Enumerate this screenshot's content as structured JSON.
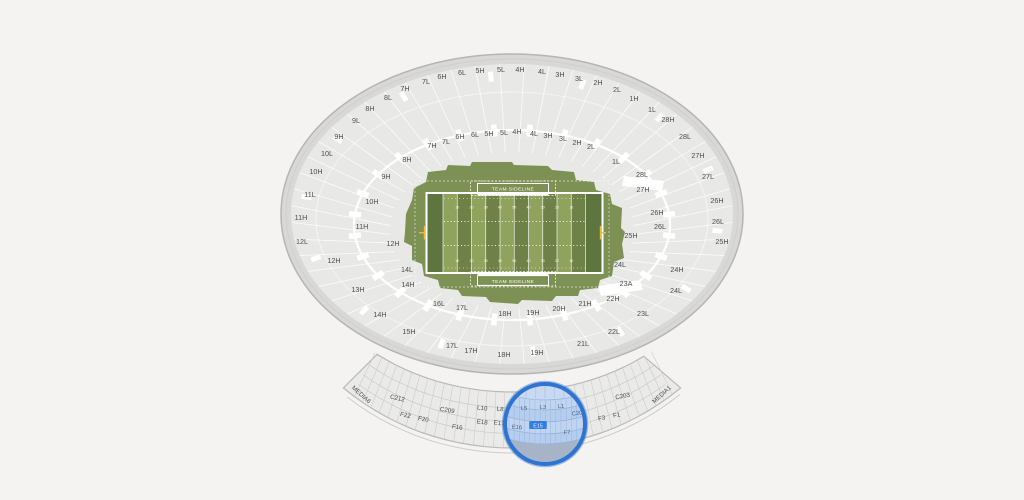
{
  "colors": {
    "bg": "#f4f3f1",
    "wall_fill": "#d8d8d6",
    "wall_stroke": "#b5b5b3",
    "wall_inner_line": "#cfcfcd",
    "bowl_fill": "#e8e8e6",
    "section_line": "#ffffff",
    "label": "#4e4e4e",
    "band_fill": "#eaeae8",
    "band_stroke": "#b9b9b7",
    "band_grid": "#c9c9c7",
    "grass": "#7e9154",
    "stripe_light": "#8fa35d",
    "stripe_dark": "#6e8147",
    "endzone": "#5f7540",
    "field_line": "#ffffff",
    "goalpost": "#e9bc3e",
    "mag_ring": "#2f74d0",
    "mag_ring_halo": "rgba(47,116,208,0.45)",
    "mag_gray": "#b4b8c0",
    "mag_top": "#dce6f5",
    "mag_row_a": "#d3e1f5",
    "mag_row_b": "#c6d8f0",
    "mag_line": "#9db8de",
    "mag_fan_line": "#c3d2ea",
    "mag_tint": "rgba(110,160,225,0.18)",
    "mag_label": "#46536a",
    "highlight": "#2277e0",
    "highlight_text": "#ffffff"
  },
  "field": {
    "sideline_top": "TEAM SIDELINE",
    "sideline_bottom": "TEAM SIDELINE",
    "yard_numbers": [
      "10",
      "20",
      "30",
      "40",
      "50",
      "40",
      "30",
      "20",
      "10"
    ]
  },
  "stadium": {
    "ring_outer": [
      {
        "t": "7H",
        "x": 405,
        "y": 91
      },
      {
        "t": "7L",
        "x": 426,
        "y": 84
      },
      {
        "t": "6H",
        "x": 442,
        "y": 79
      },
      {
        "t": "6L",
        "x": 462,
        "y": 75
      },
      {
        "t": "5H",
        "x": 480,
        "y": 73
      },
      {
        "t": "5L",
        "x": 501,
        "y": 72
      },
      {
        "t": "4H",
        "x": 520,
        "y": 72
      },
      {
        "t": "4L",
        "x": 542,
        "y": 74
      },
      {
        "t": "3H",
        "x": 560,
        "y": 77
      },
      {
        "t": "3L",
        "x": 579,
        "y": 81
      },
      {
        "t": "2H",
        "x": 598,
        "y": 85
      },
      {
        "t": "2L",
        "x": 617,
        "y": 92
      },
      {
        "t": "1H",
        "x": 634,
        "y": 101
      },
      {
        "t": "1L",
        "x": 652,
        "y": 112
      },
      {
        "t": "28H",
        "x": 668,
        "y": 122
      },
      {
        "t": "28L",
        "x": 685,
        "y": 139
      },
      {
        "t": "27H",
        "x": 698,
        "y": 158
      },
      {
        "t": "27L",
        "x": 708,
        "y": 179
      },
      {
        "t": "26H",
        "x": 717,
        "y": 203
      },
      {
        "t": "26L",
        "x": 718,
        "y": 224
      },
      {
        "t": "25H",
        "x": 722,
        "y": 244
      },
      {
        "t": "24H",
        "x": 677,
        "y": 272
      },
      {
        "t": "24L",
        "x": 676,
        "y": 293
      },
      {
        "t": "23L",
        "x": 643,
        "y": 316
      },
      {
        "t": "22L",
        "x": 614,
        "y": 334
      },
      {
        "t": "21L",
        "x": 583,
        "y": 346
      },
      {
        "t": "19H",
        "x": 537,
        "y": 355
      },
      {
        "t": "18H",
        "x": 504,
        "y": 357
      },
      {
        "t": "17H",
        "x": 471,
        "y": 353
      },
      {
        "t": "17L",
        "x": 452,
        "y": 348
      },
      {
        "t": "15H",
        "x": 409,
        "y": 334
      },
      {
        "t": "14H",
        "x": 380,
        "y": 317
      },
      {
        "t": "13H",
        "x": 358,
        "y": 292
      },
      {
        "t": "12H",
        "x": 334,
        "y": 263
      },
      {
        "t": "12L",
        "x": 302,
        "y": 244
      },
      {
        "t": "11H",
        "x": 301,
        "y": 220
      },
      {
        "t": "11L",
        "x": 310,
        "y": 197
      },
      {
        "t": "10H",
        "x": 316,
        "y": 174
      },
      {
        "t": "10L",
        "x": 327,
        "y": 156
      },
      {
        "t": "9H",
        "x": 339,
        "y": 139
      },
      {
        "t": "9L",
        "x": 356,
        "y": 123
      },
      {
        "t": "8H",
        "x": 370,
        "y": 111
      },
      {
        "t": "8L",
        "x": 388,
        "y": 100
      }
    ],
    "ring_inner": [
      {
        "t": "8H",
        "x": 407,
        "y": 162
      },
      {
        "t": "7H",
        "x": 432,
        "y": 148
      },
      {
        "t": "7L",
        "x": 446,
        "y": 144
      },
      {
        "t": "6H",
        "x": 460,
        "y": 139
      },
      {
        "t": "6L",
        "x": 475,
        "y": 137
      },
      {
        "t": "5H",
        "x": 489,
        "y": 136
      },
      {
        "t": "5L",
        "x": 504,
        "y": 135
      },
      {
        "t": "4H",
        "x": 517,
        "y": 134
      },
      {
        "t": "4L",
        "x": 534,
        "y": 136
      },
      {
        "t": "3H",
        "x": 548,
        "y": 138
      },
      {
        "t": "3L",
        "x": 563,
        "y": 141
      },
      {
        "t": "2H",
        "x": 577,
        "y": 145
      },
      {
        "t": "2L",
        "x": 591,
        "y": 149
      },
      {
        "t": "1L",
        "x": 616,
        "y": 164
      },
      {
        "t": "28L",
        "x": 642,
        "y": 177
      },
      {
        "t": "27H",
        "x": 643,
        "y": 192
      },
      {
        "t": "26H",
        "x": 657,
        "y": 215
      },
      {
        "t": "26L",
        "x": 660,
        "y": 229
      },
      {
        "t": "25H",
        "x": 631,
        "y": 238
      },
      {
        "t": "24L",
        "x": 620,
        "y": 267
      },
      {
        "t": "23A",
        "x": 626,
        "y": 286
      },
      {
        "t": "22H",
        "x": 613,
        "y": 301
      },
      {
        "t": "21H",
        "x": 585,
        "y": 306
      },
      {
        "t": "20H",
        "x": 559,
        "y": 311
      },
      {
        "t": "19H",
        "x": 533,
        "y": 315
      },
      {
        "t": "18H",
        "x": 505,
        "y": 316
      },
      {
        "t": "17L",
        "x": 462,
        "y": 310
      },
      {
        "t": "16L",
        "x": 439,
        "y": 306
      },
      {
        "t": "14H",
        "x": 408,
        "y": 287
      },
      {
        "t": "14L",
        "x": 407,
        "y": 272
      },
      {
        "t": "12H",
        "x": 393,
        "y": 246
      },
      {
        "t": "11H",
        "x": 362,
        "y": 229
      },
      {
        "t": "10H",
        "x": 372,
        "y": 204
      },
      {
        "t": "9H",
        "x": 386,
        "y": 179
      }
    ]
  },
  "lower_band": {
    "labels": [
      {
        "t": "MEDIA6",
        "x": 360,
        "y": 396,
        "r": 42
      },
      {
        "t": "C212",
        "x": 397,
        "y": 400,
        "r": 13
      },
      {
        "t": "C209",
        "x": 447,
        "y": 412,
        "r": 9
      },
      {
        "t": "L10",
        "x": 482,
        "y": 410,
        "r": 7
      },
      {
        "t": "L8",
        "x": 500,
        "y": 411,
        "r": 6
      },
      {
        "t": "F22",
        "x": 405,
        "y": 417,
        "r": 13
      },
      {
        "t": "F20",
        "x": 423,
        "y": 421,
        "r": 11
      },
      {
        "t": "F16",
        "x": 457,
        "y": 429,
        "r": 8
      },
      {
        "t": "E18",
        "x": 482,
        "y": 424,
        "r": 7
      },
      {
        "t": "E17",
        "x": 499,
        "y": 425,
        "r": 6
      },
      {
        "t": "C203",
        "x": 623,
        "y": 398,
        "r": -11
      },
      {
        "t": "F3",
        "x": 602,
        "y": 420,
        "r": -9
      },
      {
        "t": "F1",
        "x": 617,
        "y": 417,
        "r": -10
      },
      {
        "t": "MEDIA1",
        "x": 663,
        "y": 396,
        "r": -42
      }
    ]
  },
  "magnifier": {
    "cx": 545,
    "cy": 424,
    "r": 40,
    "labels": [
      {
        "t": "L5",
        "x": 524,
        "y": 408,
        "r": 3
      },
      {
        "t": "L3",
        "x": 543,
        "y": 407,
        "r": 0
      },
      {
        "t": "L1",
        "x": 561,
        "y": 406,
        "r": -3
      },
      {
        "t": "C20",
        "x": 577,
        "y": 413,
        "r": -8
      },
      {
        "t": "E16",
        "x": 517,
        "y": 427,
        "r": 4
      },
      {
        "t": "F7",
        "x": 567,
        "y": 432,
        "r": -6
      }
    ],
    "highlight": {
      "t": "E15",
      "x": 538,
      "y": 425
    }
  }
}
